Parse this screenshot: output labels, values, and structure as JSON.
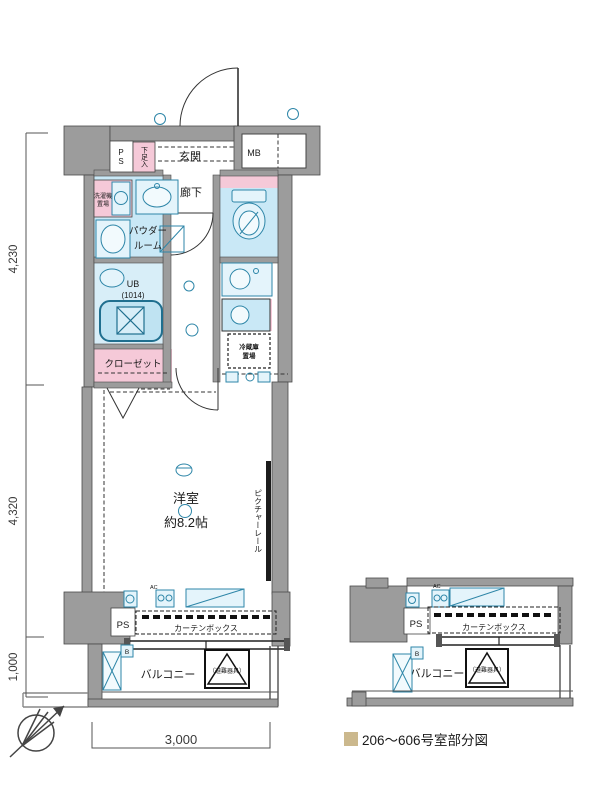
{
  "plan": {
    "rooms": {
      "entrance": "玄関",
      "hallway": "廊下",
      "powder_room_line1": "パウダー",
      "powder_room_line2": "ルーム",
      "unit_bath": "UB",
      "unit_bath_size": "(1014)",
      "closet": "クローゼット",
      "main_room_line1": "洋室",
      "main_room_line2": "約8.2帖",
      "balcony": "バルコニー"
    },
    "fixtures": {
      "pipe_space_top": "PS",
      "pipe_space_bottom": "PS",
      "meter_box": "MB",
      "shoe_cabinet": "下足入",
      "washer_line1": "洗濯機",
      "washer_line2": "置場",
      "fridge_line1": "冷蔵庫",
      "fridge_line2": "置場",
      "curtain_box": "カーテンボックス",
      "picture_rail": "ピクチャーレール",
      "evac_hatch": "（避難器具）",
      "balcony_drain": "B",
      "air_conditioner": "AC"
    }
  },
  "partial": {
    "pipe_space": "PS",
    "curtain_box": "カーテンボックス",
    "balcony": "バルコニー",
    "evac_hatch": "（避難器具）",
    "balcony_drain": "B",
    "air_conditioner": "AC"
  },
  "dimensions": {
    "height_upper": "4,230",
    "height_middle": "4,320",
    "height_lower": "1,000",
    "width_bottom": "3,000"
  },
  "legend": {
    "text": "206～606号室部分図"
  },
  "colors": {
    "wall": "#9c9c9c",
    "wet_area": "#c9e8f6",
    "pink_area": "#f5c9d8",
    "fixture_stroke": "#2e86a8",
    "legend_swatch": "#cbb88d"
  }
}
